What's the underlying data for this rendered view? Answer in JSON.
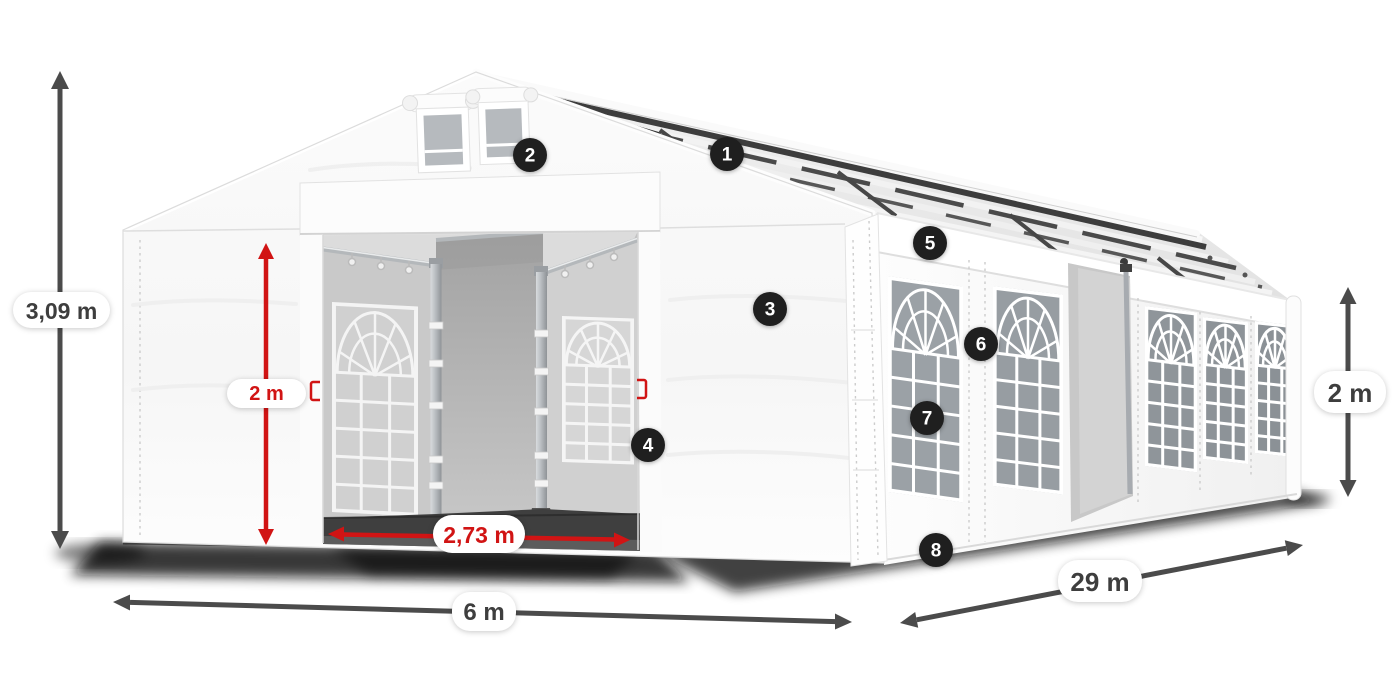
{
  "dimensions": {
    "total_height": "3,09 m",
    "entrance_height": "2 m",
    "entrance_width": "2,73 m",
    "width": "6 m",
    "length": "29 m",
    "side_height": "2 m"
  },
  "hotspots": [
    {
      "number": "1"
    },
    {
      "number": "2"
    },
    {
      "number": "3"
    },
    {
      "number": "4"
    },
    {
      "number": "5"
    },
    {
      "number": "6"
    },
    {
      "number": "7"
    },
    {
      "number": "8"
    }
  ],
  "colors": {
    "dimension_red": "#d11414",
    "dimension_dark": "#4b4b4b",
    "badge_background": "#1f1f1f",
    "background": "#ffffff"
  }
}
